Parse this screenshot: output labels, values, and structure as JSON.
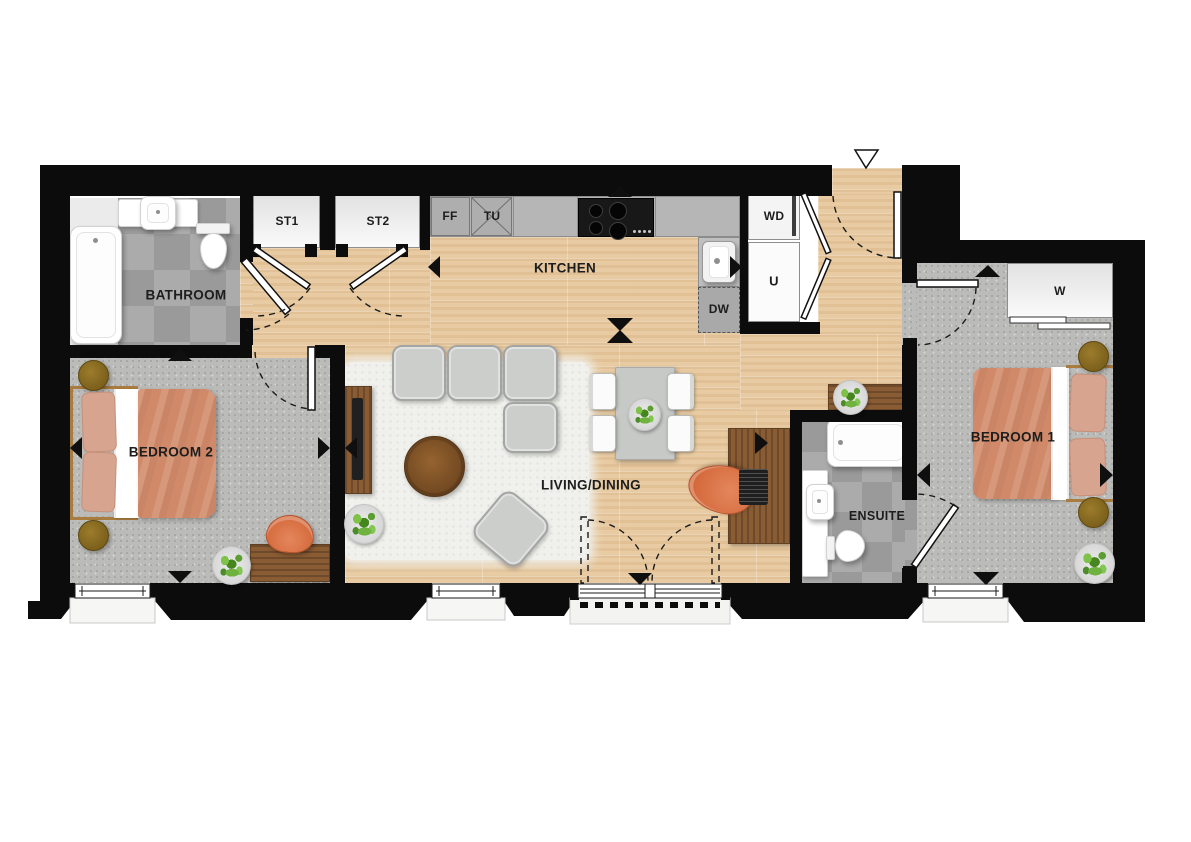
{
  "plan": {
    "type": "apartment-floorplan",
    "rooms": {
      "bathroom": {
        "label": "BATHROOM"
      },
      "kitchen": {
        "label": "KITCHEN"
      },
      "living_dining": {
        "label": "LIVING/DINING"
      },
      "bedroom1": {
        "label": "BEDROOM 1"
      },
      "bedroom2": {
        "label": "BEDROOM 2"
      },
      "ensuite": {
        "label": "ENSUITE"
      }
    },
    "units": {
      "st1": "ST1",
      "st2": "ST2",
      "ff": "FF",
      "tu": "TU",
      "dw": "DW",
      "wd": "WD",
      "u": "U",
      "w": "W"
    },
    "colors": {
      "wall": "#0c0c0c",
      "wood_floor": "#e8cba2",
      "carpet": "#bbbbb9",
      "tile": "#a2a2a2",
      "fixture_white": "#ffffff",
      "duvet_orange": "#d18a69",
      "pillow": "#d7a48f",
      "sofa_grey": "#cccecc",
      "furniture_wood": "#8a5c34",
      "side_table_olive": "#8c6f22",
      "chair_orange": "#d46a3c",
      "plant_green": "#6fb23f",
      "label_text": "#1d1d1d"
    }
  }
}
